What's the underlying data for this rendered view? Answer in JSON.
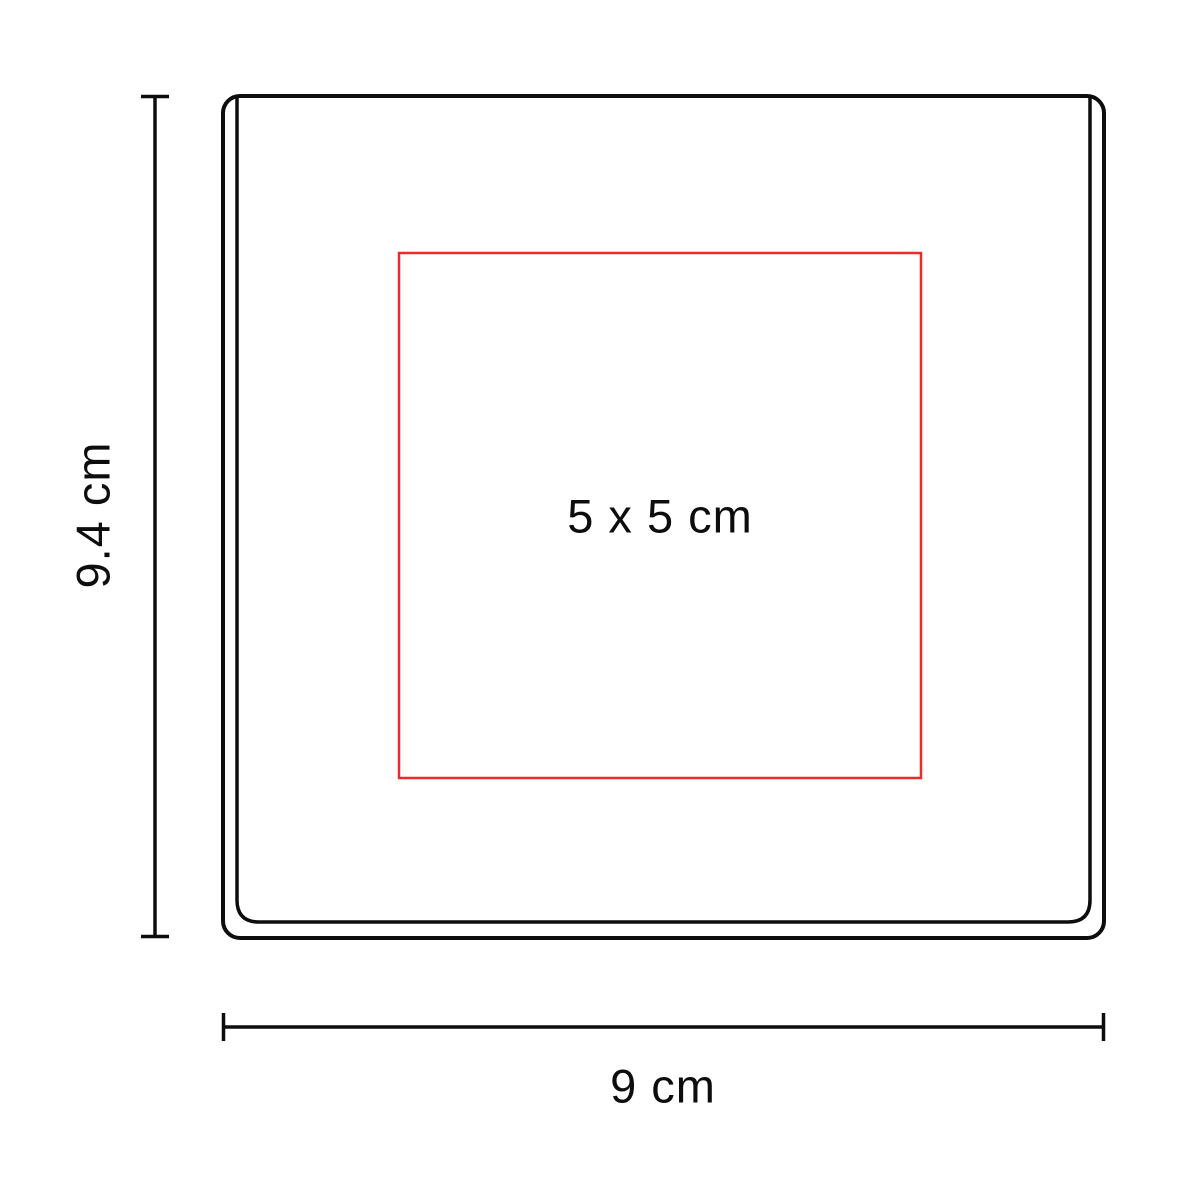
{
  "diagram": {
    "type": "product-print-area-dimension-diagram",
    "product_height_label": "9.4 cm",
    "product_width_label": "9 cm",
    "print_area_label": "5 x 5 cm"
  },
  "colors": {
    "line": "#0d0d0d",
    "print_area": "#ed2b2f",
    "background": "#ffffff"
  }
}
